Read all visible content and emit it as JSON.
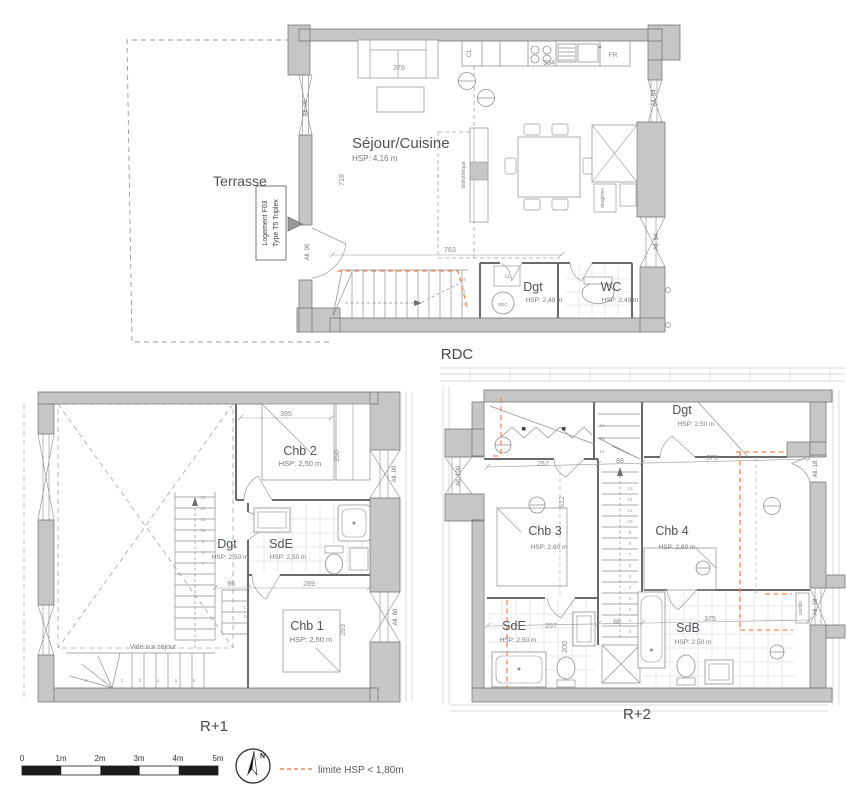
{
  "colors": {
    "wall_fill": "#c6c6c6",
    "wall_line": "#6f6f6f",
    "partition_line": "#6a6a6a",
    "furniture_line": "#9a9a9a",
    "tile_line": "#d2d2d2",
    "dimension_text": "#8a8a8a",
    "room_label": "#4d5258",
    "hsp_text": "#75797d",
    "hsp_limit_orange": "#f0875a"
  },
  "levels": {
    "rdc": {
      "label": "RDC",
      "rooms": {
        "sejour_cuisine": {
          "name": "Séjour/Cuisine",
          "hsp": "HSP: 4,16 m"
        },
        "dgt": {
          "name": "Dgt",
          "hsp": "HSP: 2,49 m"
        },
        "wc": {
          "name": "WC",
          "hsp": "HSP: 2,49 m"
        }
      },
      "outdoor": {
        "terrasse": "Terrasse"
      },
      "unit_tag": {
        "line1": "Logement F03",
        "line2": "Type T5 Triplex"
      },
      "dimensions": {
        "sofa_width": "376",
        "kitchen_width": "384",
        "entry_height": "718",
        "lower_width": "763"
      },
      "alleges": {
        "left_top": "All. 00",
        "left_bottom": "All. 00",
        "right_top": "All. 54",
        "right_mid": "All. 54"
      },
      "fixtures": {
        "fridge": "FR",
        "closet": "CL",
        "washer": "LL",
        "water_heater": "BEC",
        "bookshelf": "bibliothèque",
        "shelves": "étagères"
      },
      "stair_numbers": [
        "12",
        "13",
        "14"
      ]
    },
    "r1": {
      "label": "R+1",
      "rooms": {
        "chb2": {
          "name": "Chb 2",
          "hsp": "HSP: 2,50 m"
        },
        "dgt": {
          "name": "Dgt",
          "hsp": "HSP: 2,50 m"
        },
        "sde": {
          "name": "SdE",
          "hsp": "HSP: 2,50 m"
        },
        "chb1": {
          "name": "Chb 1",
          "hsp": "HSP: 2,50 m"
        }
      },
      "void_label": "Vide sur séjour",
      "dimensions": {
        "chb2_width": "395",
        "chb2_depth": "250",
        "corridor": "95",
        "chb1_width": "289",
        "chb1_depth": "293"
      },
      "alleges": {
        "right_top": "All. 90",
        "right_bottom": "All. 80"
      },
      "stair_numbers_run": [
        "7",
        "8",
        "9",
        "10",
        "11",
        "12",
        "13"
      ],
      "stair_numbers_low": [
        "0",
        "1",
        "2",
        "3",
        "4",
        "5",
        "6"
      ],
      "stair_numbers_upper": [
        "16",
        "17"
      ]
    },
    "r2": {
      "label": "R+2",
      "rooms": {
        "dgt": {
          "name": "Dgt",
          "hsp": "HSP: 2,50 m"
        },
        "chb3": {
          "name": "Chb 3",
          "hsp": "HSP: 2,60 m"
        },
        "chb4": {
          "name": "Chb 4",
          "hsp": "HSP: 2,60 m"
        },
        "sde": {
          "name": "SdE",
          "hsp": "HSP: 2,50 m"
        },
        "sdb": {
          "name": "SdB",
          "hsp": "HSP: 2,50 m"
        }
      },
      "dimensions": {
        "upper_left": "257",
        "upper_mid": "88",
        "upper_right": "375",
        "left_depth": "512",
        "lower_left": "257",
        "lower_mid": "88",
        "lower_right": "375",
        "sde_depth": "200"
      },
      "alleges": {
        "left": "All. 100",
        "right_top": "All. 18",
        "right_bottom": "All. 18",
        "window_type": "oscillo"
      },
      "stair_numbers_top": [
        "14",
        "15",
        "16"
      ],
      "stair_numbers_run": [
        "13",
        "12",
        "11",
        "10",
        "9",
        "8",
        "7",
        "6",
        "5",
        "4",
        "3",
        "2",
        "1",
        "0"
      ]
    }
  },
  "legend": {
    "scale_ticks": [
      "0",
      "1m",
      "2m",
      "3m",
      "4m",
      "5m"
    ],
    "north_label": "N",
    "hsp_note": "limite HSP < 1,80m"
  }
}
